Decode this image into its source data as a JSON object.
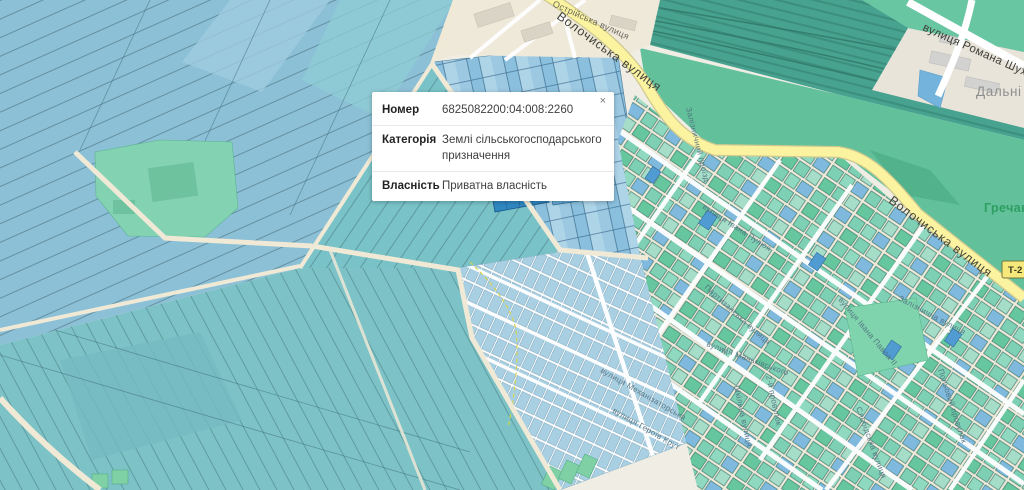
{
  "popup": {
    "close_label": "×",
    "rows": [
      {
        "label": "Номер",
        "value": "6825082200:04:008:2260"
      },
      {
        "label": "Категорія",
        "value": "Землі сільськогосподарського призначення"
      },
      {
        "label": "Власність",
        "value": "Приватна власність"
      }
    ]
  },
  "labels": {
    "volochyska_top": "Волочиська вулиця",
    "volochyska_right": "Волочиська вулиця",
    "shukhevycha": "вулиця Романа Шухевича",
    "ostriiska": "Острійська вулиця",
    "zaliznychna": "Залізнична вулиця",
    "ivana_pavla": "вулиця Івана Павла II",
    "polovyi": "Польовий провулок",
    "zal_proizd": "Залізничний проїзд",
    "puliuia": "вулиця Івана Пулюя",
    "partyzanska": "Партизанська вулиця",
    "mankivskoho": "вулиця Маньківського",
    "shkilna": "Шкільна вулиця",
    "prov2": "2-й провулок",
    "mekhanizatorska": "вулиця Механізаторська",
    "heroiv": "вулиця Героїв Крут",
    "slobidska": "Слобідська вулиця",
    "dalni": "Дальні Гречани",
    "hrechany": "Гречани",
    "shield_t2": "Т-2"
  },
  "colors": {
    "field_blue": "#8cc0d6",
    "field_teal": "#7cc2c6",
    "urban_teal": "#7ed0b4",
    "selected_parcel": "#2f87c1",
    "road_yellow": "#fbf3a0",
    "railway": "#47a28f",
    "background": "#f0ede4",
    "popup_bg": "#ffffff"
  }
}
